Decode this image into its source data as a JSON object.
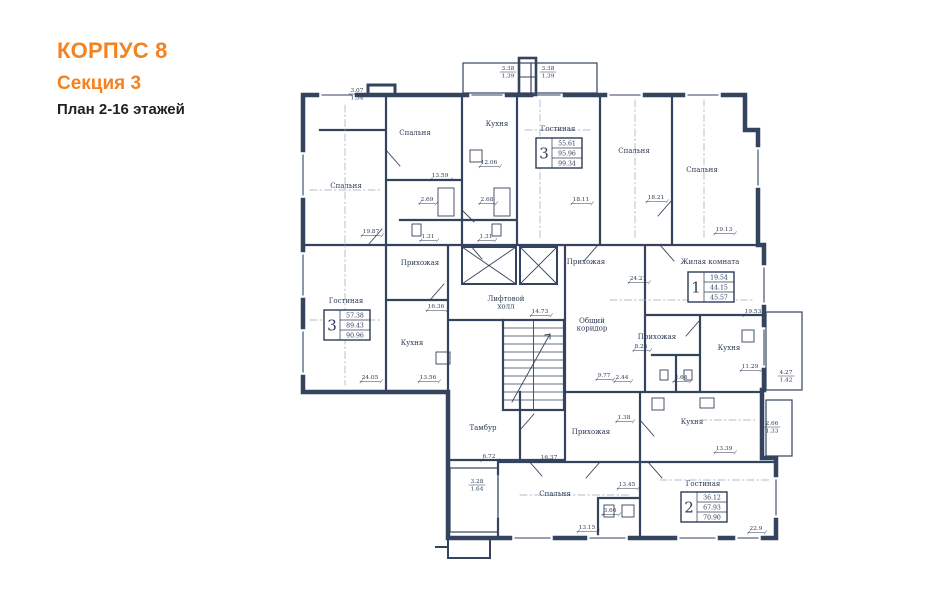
{
  "header": {
    "building": "КОРПУС 8",
    "section": "Секция 3",
    "plan_label": "План 2-16 этажей",
    "accent_color": "#F58220"
  },
  "plan": {
    "ink_color": "#34435e",
    "label_color": "#2c3b57",
    "room_labels": [
      {
        "t": "Спальня",
        "x": 415,
        "y": 135
      },
      {
        "t": "Кухня",
        "x": 497,
        "y": 126
      },
      {
        "t": "Спальня",
        "x": 346,
        "y": 188
      },
      {
        "t": "Гостиная",
        "x": 558,
        "y": 131
      },
      {
        "t": "Спальня",
        "x": 634,
        "y": 153
      },
      {
        "t": "Спальня",
        "x": 702,
        "y": 172
      },
      {
        "t": "Гостиная",
        "x": 346,
        "y": 303
      },
      {
        "t": "Прихожая",
        "x": 420,
        "y": 265
      },
      {
        "t": "Кухня",
        "x": 412,
        "y": 345
      },
      {
        "t": "Жилая комната",
        "x": 710,
        "y": 264
      },
      {
        "t": "Прихожая",
        "x": 586,
        "y": 264
      },
      {
        "t": "Прихожая",
        "x": 657,
        "y": 339
      },
      {
        "t": "Кухня",
        "x": 729,
        "y": 350
      },
      {
        "lines": [
          "Лифтовой",
          "холл"
        ],
        "x": 506,
        "y": 301
      },
      {
        "lines": [
          "Общий",
          "коридор"
        ],
        "x": 592,
        "y": 323
      },
      {
        "t": "Кухня",
        "x": 692,
        "y": 424
      },
      {
        "t": "Прихожая",
        "x": 591,
        "y": 434
      },
      {
        "t": "Тамбур",
        "x": 483,
        "y": 430
      },
      {
        "t": "Спальня",
        "x": 555,
        "y": 496
      },
      {
        "t": "Гостиная",
        "x": 703,
        "y": 486
      }
    ],
    "dimensions": [
      {
        "t": "13.59",
        "x": 440,
        "y": 177
      },
      {
        "t": "12.06",
        "x": 489,
        "y": 164
      },
      {
        "t": "2.69",
        "x": 427,
        "y": 201
      },
      {
        "t": "2.68",
        "x": 487,
        "y": 201
      },
      {
        "t": "1.31",
        "x": 428,
        "y": 238
      },
      {
        "t": "1.31",
        "x": 486,
        "y": 238
      },
      {
        "t": "19.87",
        "x": 371,
        "y": 233
      },
      {
        "t": "18.11",
        "x": 581,
        "y": 201
      },
      {
        "t": "18.21",
        "x": 656,
        "y": 199
      },
      {
        "t": "19.13",
        "x": 724,
        "y": 231
      },
      {
        "t": "24.21",
        "x": 638,
        "y": 280
      },
      {
        "t": "19.53",
        "x": 753,
        "y": 313
      },
      {
        "t": "8.25",
        "x": 641,
        "y": 348
      },
      {
        "t": "11.29",
        "x": 750,
        "y": 368
      },
      {
        "t": "9.77",
        "x": 604,
        "y": 377
      },
      {
        "t": "2.44",
        "x": 622,
        "y": 379
      },
      {
        "t": "2.64",
        "x": 681,
        "y": 379
      },
      {
        "t": "14.73",
        "x": 540,
        "y": 313
      },
      {
        "t": "16.36",
        "x": 436,
        "y": 308
      },
      {
        "t": "24.05",
        "x": 370,
        "y": 379
      },
      {
        "t": "13.56",
        "x": 428,
        "y": 379
      },
      {
        "t": "6.72",
        "x": 489,
        "y": 458
      },
      {
        "t": "16.37",
        "x": 549,
        "y": 459
      },
      {
        "t": "13.39",
        "x": 724,
        "y": 450
      },
      {
        "t": "13.45",
        "x": 627,
        "y": 486
      },
      {
        "t": "3.66",
        "x": 610,
        "y": 512
      },
      {
        "t": "13.15",
        "x": 587,
        "y": 529
      },
      {
        "t": "22.9",
        "x": 756,
        "y": 530
      },
      {
        "t": "1.38",
        "x": 624,
        "y": 419
      }
    ],
    "fraction_dims": [
      {
        "a": "3.07",
        "b": "1.54",
        "x": 357,
        "y": 92
      },
      {
        "a": "3.38",
        "b": "1.39",
        "x": 508,
        "y": 70
      },
      {
        "a": "3.38",
        "b": "1.39",
        "x": 548,
        "y": 70
      },
      {
        "a": "4.27",
        "b": "1.42",
        "x": 786,
        "y": 374
      },
      {
        "a": "2.66",
        "b": "1.33",
        "x": 772,
        "y": 425
      },
      {
        "a": "3.28",
        "b": "1.64",
        "x": 477,
        "y": 483
      }
    ],
    "apartments": [
      {
        "n": "3",
        "v": [
          "55.61",
          "95.96",
          "99.34"
        ],
        "x": 536,
        "y": 138
      },
      {
        "n": "3",
        "v": [
          "57.38",
          "89.43",
          "90.96"
        ],
        "x": 324,
        "y": 310
      },
      {
        "n": "1",
        "v": [
          "19.54",
          "44.15",
          "45.57"
        ],
        "x": 688,
        "y": 272
      },
      {
        "n": "2",
        "v": [
          "36.12",
          "67.93",
          "70.90"
        ],
        "x": 681,
        "y": 492
      }
    ]
  }
}
